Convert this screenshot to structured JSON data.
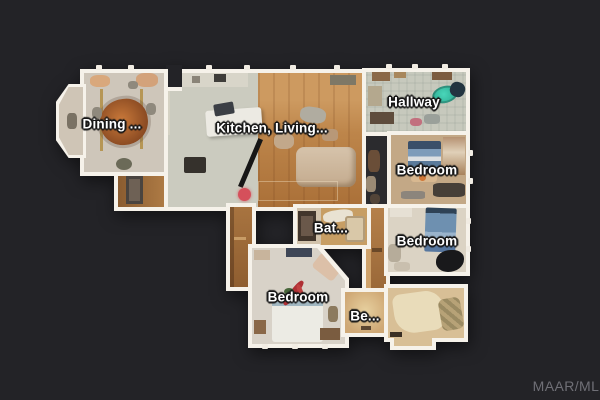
{
  "view": {
    "background_color": "#232327",
    "wall_color": "#f6f2ea"
  },
  "rooms": [
    {
      "id": "dining",
      "label": "Dining ..."
    },
    {
      "id": "kitchen-living",
      "label": "Kitchen, Living..."
    },
    {
      "id": "hallway",
      "label": "Hallway"
    },
    {
      "id": "bedroom-upper-right",
      "label": "Bedroom"
    },
    {
      "id": "bedroom-mid-right",
      "label": "Bedroom"
    },
    {
      "id": "bathroom",
      "label": "Bat..."
    },
    {
      "id": "bedroom-bottom",
      "label": "Bedroom"
    },
    {
      "id": "bedroom-partial",
      "label": "Be..."
    }
  ],
  "marker": {
    "name": "current-position-dot",
    "color": "#d5505b"
  },
  "accent_colors": {
    "bathtub_teal": "#3ad0b2",
    "living_wood_floor": "#bd854a",
    "kitchen_floor": "#cbcbbf",
    "bed_denim": "#6e90b0"
  },
  "watermark": {
    "text": "MAAR/MLS",
    "color": "#6f6f76"
  }
}
